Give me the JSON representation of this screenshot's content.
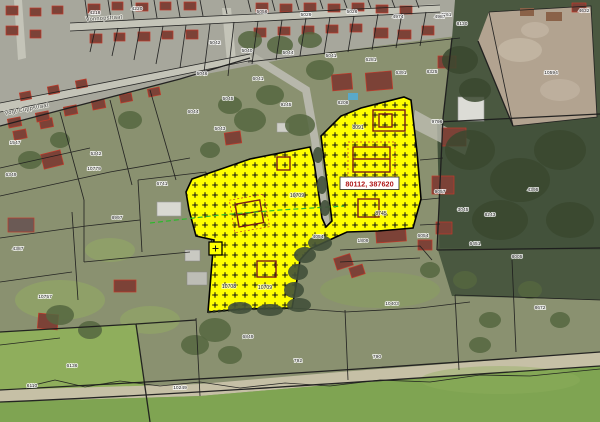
{
  "app": {
    "type": "cadastral-map-viewer"
  },
  "map": {
    "coordinate_label": "80112, 387620",
    "colors": {
      "selection_fill": "#ffff00",
      "selection_marker": "#131313",
      "coordinate_text": "#b01818",
      "parcel_line": "#1c1c1c",
      "guide_line_green": "#2db92d"
    },
    "street_labels": [
      {
        "text": "Vonnopstraat",
        "x": 86,
        "y": 21,
        "angle": -4
      },
      {
        "text": "Vogt Cuppstraat",
        "x": 5,
        "y": 115,
        "angle": -11
      }
    ],
    "selection": {
      "labels": [
        {
          "text": "8091",
          "x": 358,
          "y": 129
        },
        {
          "text": "8745",
          "x": 381,
          "y": 215
        },
        {
          "text": "10709",
          "x": 297,
          "y": 197
        },
        {
          "text": "10708",
          "x": 229,
          "y": 288
        },
        {
          "text": "10709",
          "x": 265,
          "y": 289
        }
      ]
    },
    "parcel_labels": [
      {
        "text": "4218",
        "x": 95,
        "y": 14
      },
      {
        "text": "4220",
        "x": 137,
        "y": 10
      },
      {
        "text": "5056",
        "x": 262,
        "y": 13
      },
      {
        "text": "5029",
        "x": 306,
        "y": 16
      },
      {
        "text": "5026",
        "x": 352,
        "y": 13
      },
      {
        "text": "4974",
        "x": 398,
        "y": 18
      },
      {
        "text": "4961",
        "x": 446,
        "y": 16
      },
      {
        "text": "5042",
        "x": 215,
        "y": 44
      },
      {
        "text": "5040",
        "x": 247,
        "y": 52
      },
      {
        "text": "5044",
        "x": 288,
        "y": 54
      },
      {
        "text": "5041",
        "x": 331,
        "y": 57
      },
      {
        "text": "6281",
        "x": 371,
        "y": 61
      },
      {
        "text": "6391",
        "x": 401,
        "y": 74
      },
      {
        "text": "8325",
        "x": 432,
        "y": 73
      },
      {
        "text": "8208",
        "x": 343,
        "y": 104
      },
      {
        "text": "5046",
        "x": 202,
        "y": 75
      },
      {
        "text": "6044",
        "x": 193,
        "y": 113
      },
      {
        "text": "5045",
        "x": 228,
        "y": 100
      },
      {
        "text": "5043",
        "x": 220,
        "y": 130
      },
      {
        "text": "6041",
        "x": 258,
        "y": 80
      },
      {
        "text": "9245",
        "x": 286,
        "y": 106
      },
      {
        "text": "6741",
        "x": 162,
        "y": 185
      },
      {
        "text": "1547",
        "x": 15,
        "y": 144
      },
      {
        "text": "6349",
        "x": 11,
        "y": 176
      },
      {
        "text": "5342",
        "x": 96,
        "y": 155
      },
      {
        "text": "10779",
        "x": 94,
        "y": 170
      },
      {
        "text": "8997",
        "x": 117,
        "y": 219
      },
      {
        "text": "4387",
        "x": 18,
        "y": 250
      },
      {
        "text": "10757",
        "x": 45,
        "y": 298
      },
      {
        "text": "6110",
        "x": 32,
        "y": 387
      },
      {
        "text": "6136",
        "x": 72,
        "y": 367
      },
      {
        "text": "10249",
        "x": 180,
        "y": 389
      },
      {
        "text": "6849",
        "x": 248,
        "y": 338
      },
      {
        "text": "792",
        "x": 298,
        "y": 362
      },
      {
        "text": "790",
        "x": 377,
        "y": 358
      },
      {
        "text": "10403",
        "x": 392,
        "y": 305
      },
      {
        "text": "8005",
        "x": 517,
        "y": 258
      },
      {
        "text": "8672",
        "x": 540,
        "y": 309
      },
      {
        "text": "4054",
        "x": 318,
        "y": 238
      },
      {
        "text": "1809",
        "x": 363,
        "y": 242
      },
      {
        "text": "6054",
        "x": 423,
        "y": 237
      },
      {
        "text": "9796",
        "x": 437,
        "y": 123
      },
      {
        "text": "4395",
        "x": 533,
        "y": 191
      },
      {
        "text": "9057",
        "x": 440,
        "y": 193
      },
      {
        "text": "3045",
        "x": 463,
        "y": 211
      },
      {
        "text": "8243",
        "x": 490,
        "y": 216
      },
      {
        "text": "6451",
        "x": 475,
        "y": 245
      },
      {
        "text": "8130",
        "x": 462,
        "y": 25
      },
      {
        "text": "4987",
        "x": 440,
        "y": 18
      },
      {
        "text": "10594",
        "x": 551,
        "y": 74
      },
      {
        "text": "4632",
        "x": 584,
        "y": 12
      }
    ]
  }
}
